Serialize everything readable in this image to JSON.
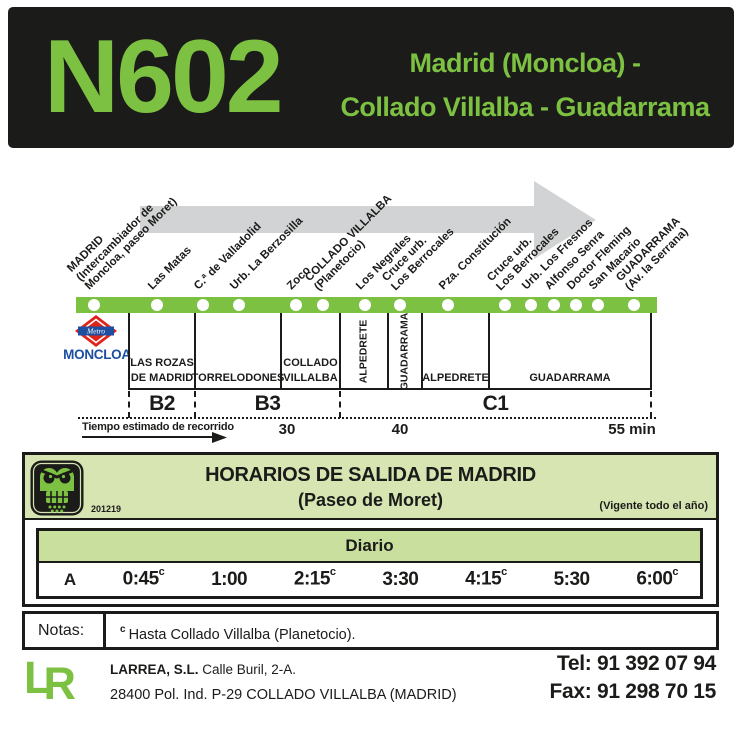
{
  "header": {
    "line_number": "N602",
    "route_line1": "Madrid (Moncloa) -",
    "route_line2": "Collado Villalba - Guadarrama"
  },
  "diagram": {
    "stops": [
      {
        "x": 94,
        "lines": [
          "MADRID",
          "(Intercambiador de",
          "Moncloa, paseo Moret)"
        ]
      },
      {
        "x": 157,
        "lines": [
          "Las Matas"
        ]
      },
      {
        "x": 203,
        "lines": [
          "C.ª de Valladolid"
        ]
      },
      {
        "x": 239,
        "lines": [
          "Urb. La Berzosilla"
        ]
      },
      {
        "x": 296,
        "lines": [
          "Zoco"
        ]
      },
      {
        "x": 323,
        "lines": [
          "COLLADO VILLALBA",
          "(Planetocio)"
        ]
      },
      {
        "x": 365,
        "lines": [
          "Los Negrales"
        ]
      },
      {
        "x": 400,
        "lines": [
          "Cruce urb.",
          "Los Berrocales"
        ]
      },
      {
        "x": 448,
        "lines": [
          "Pza. Constitución"
        ]
      },
      {
        "x": 505,
        "lines": [
          "Cruce urb.",
          "Los Berrocales"
        ]
      },
      {
        "x": 531,
        "lines": [
          "Urb. Los Fresnos"
        ]
      },
      {
        "x": 554,
        "lines": [
          "Alfonso Senra"
        ]
      },
      {
        "x": 576,
        "lines": [
          "Doctor Fleming"
        ]
      },
      {
        "x": 598,
        "lines": [
          "San Macario"
        ]
      },
      {
        "x": 634,
        "lines": [
          "GUADARRAMA",
          "(Av. la Serrana)"
        ]
      }
    ],
    "metro": {
      "station": "MONCLOA",
      "logo_text": "Metro"
    },
    "mun_boundaries": [
      129,
      195,
      281,
      340,
      388,
      422,
      489,
      651
    ],
    "municipalities": [
      {
        "x1": 129,
        "x2": 195,
        "lines": [
          "LAS ROZAS",
          "DE MADRID"
        ],
        "vertical": false
      },
      {
        "x1": 195,
        "x2": 281,
        "lines": [
          "TORRELODONES"
        ],
        "vertical": false
      },
      {
        "x1": 281,
        "x2": 340,
        "lines": [
          "COLLADO",
          "VILLALBA"
        ],
        "vertical": false
      },
      {
        "x1": 340,
        "x2": 388,
        "lines": [
          "ALPEDRETE"
        ],
        "vertical": true
      },
      {
        "x1": 388,
        "x2": 422,
        "lines": [
          "GUADARRAMA"
        ],
        "vertical": true
      },
      {
        "x1": 422,
        "x2": 489,
        "lines": [
          "ALPEDRETE"
        ],
        "vertical": false
      },
      {
        "x1": 489,
        "x2": 651,
        "lines": [
          "GUADARRAMA"
        ],
        "vertical": false
      }
    ],
    "zone_boundaries": [
      129,
      195,
      340,
      651
    ],
    "zones": [
      {
        "label": "B2",
        "x1": 129,
        "x2": 195
      },
      {
        "label": "B3",
        "x1": 195,
        "x2": 340
      },
      {
        "label": "C1",
        "x1": 340,
        "x2": 651
      }
    ],
    "travel": {
      "label": "Tiempo estimado de recorrido",
      "marks": [
        {
          "text": "30",
          "x": 287
        },
        {
          "text": "40",
          "x": 400
        },
        {
          "text": "55 min",
          "x": 632
        }
      ]
    }
  },
  "timetable": {
    "print_code": "201219",
    "title_line1": "HORARIOS DE SALIDA DE MADRID",
    "title_line2": "(Paseo de Moret)",
    "validity": "(Vigente todo el año)",
    "day_type": "Diario",
    "row_label": "A",
    "times": [
      {
        "t": "0:45",
        "sup": "c"
      },
      {
        "t": "1:00",
        "sup": ""
      },
      {
        "t": "2:15",
        "sup": "c"
      },
      {
        "t": "3:30",
        "sup": ""
      },
      {
        "t": "4:15",
        "sup": "c"
      },
      {
        "t": "5:30",
        "sup": ""
      },
      {
        "t": "6:00",
        "sup": "c"
      }
    ]
  },
  "notes": {
    "label": "Notas:",
    "sup": "c",
    "text": "Hasta Collado Villalba (Planetocio)."
  },
  "footer": {
    "logo_l": "L",
    "logo_r": "R",
    "company": "LARREA, S.L.",
    "address1": "Calle Buril, 2-A.",
    "address2": "28400 Pol. Ind. P-29 COLLADO VILLALBA (MADRID)",
    "tel_label": "Tel: ",
    "tel_number": "91 392 07 94",
    "fax_label": "Fax: ",
    "fax_number": "91 298 70 15"
  },
  "colors": {
    "line_green": "#7dc142",
    "header_black": "#1b1b19",
    "band_green": "#d6e5b2",
    "diario_green": "#c9df9e",
    "arrow_gray": "#d1d3d4",
    "metro_red": "#df2318",
    "metro_blue": "#1d4fa1"
  }
}
